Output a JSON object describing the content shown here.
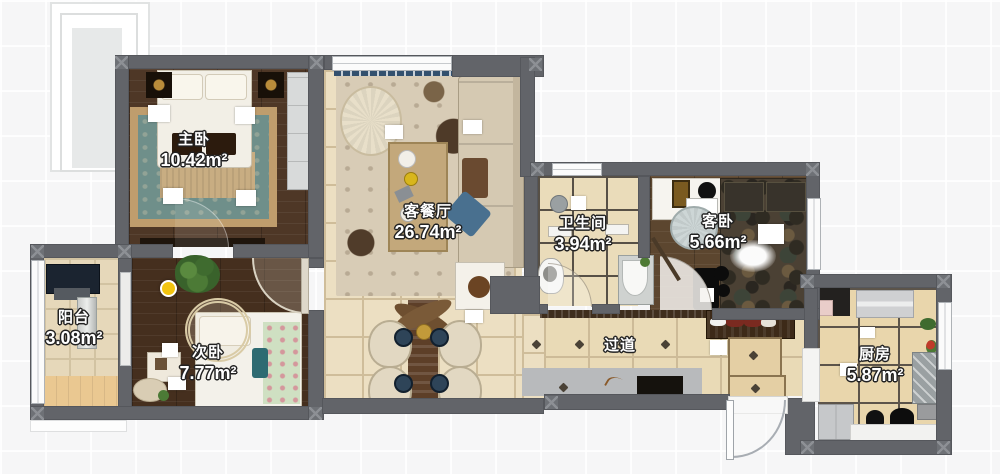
{
  "plan_title": "apartment-floor-plan",
  "rooms": [
    {
      "id": "master-bedroom",
      "name": "主卧",
      "area": "10.42m²"
    },
    {
      "id": "living-dining",
      "name": "客餐厅",
      "area": "26.74m²"
    },
    {
      "id": "bathroom",
      "name": "卫生间",
      "area": "3.94m²"
    },
    {
      "id": "guest-bedroom",
      "name": "客卧",
      "area": "5.66m²"
    },
    {
      "id": "balcony",
      "name": "阳台",
      "area": "3.08m²"
    },
    {
      "id": "second-bedroom",
      "name": "次卧",
      "area": "7.77m²"
    },
    {
      "id": "hallway",
      "name": "过道",
      "area": ""
    },
    {
      "id": "kitchen",
      "name": "厨房",
      "area": "5.87m²"
    }
  ],
  "colors": {
    "wall": "#626469",
    "tile_floor": "#ecdfc2",
    "dark_wood_floor": "#4e3726",
    "label_text": "#ffffff",
    "indicator_dot": "#f2c410",
    "accent_pillow_blue": "#49708f"
  }
}
